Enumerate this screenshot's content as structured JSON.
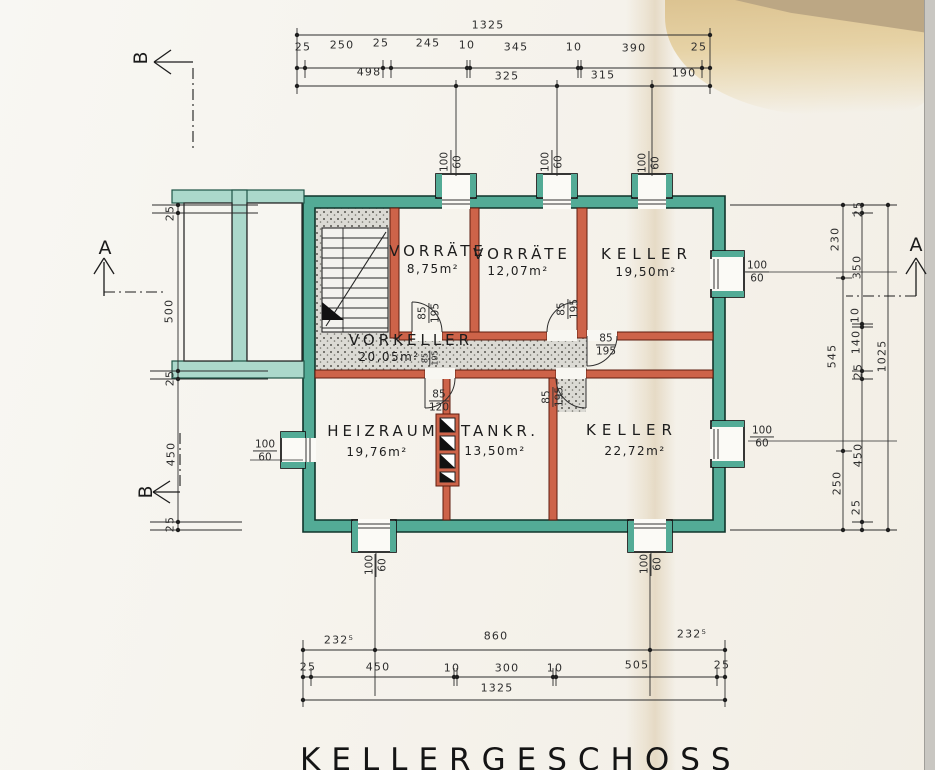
{
  "title": "KELLERGESCHOSS",
  "rooms": [
    {
      "name": "VORRÄTE",
      "area": "8,75m²"
    },
    {
      "name": "VORRÄTE",
      "area": "12,07m²"
    },
    {
      "name": "KELLER",
      "area": "19,50m²"
    },
    {
      "name": "VORKELLER",
      "area": "20,05m²"
    },
    {
      "name": "HEIZRAUM",
      "area": "19,76m²"
    },
    {
      "name": "TANKR.",
      "area": "13,50m²"
    },
    {
      "name": "KELLER",
      "area": "22,72m²"
    }
  ],
  "section_markers": {
    "a": "A",
    "b": "B"
  },
  "labels": {
    "window": {
      "num": "100",
      "den": "60"
    },
    "door_standard": {
      "num": "85",
      "den": "195"
    },
    "door_heizraum": {
      "num": "85",
      "den": "120"
    }
  },
  "dims": {
    "top": {
      "total": "1325",
      "row2": [
        "25",
        "250",
        "25",
        "245",
        "10",
        "345",
        "10",
        "390",
        "25"
      ],
      "row3": [
        "498",
        "325",
        "315",
        "190"
      ]
    },
    "bottom": {
      "row1": [
        "232⁵",
        "860",
        "232⁵"
      ],
      "row2": [
        "25",
        "450",
        "10",
        "300",
        "10",
        "505",
        "25"
      ],
      "total": "1325"
    },
    "left": [
      "25",
      "500",
      "25",
      "450",
      "25"
    ],
    "right": {
      "col1": [
        "230",
        "545",
        "250"
      ],
      "col2": [
        "25",
        "350",
        "10",
        "140",
        "25",
        "450",
        "25"
      ],
      "total": "1025"
    }
  }
}
